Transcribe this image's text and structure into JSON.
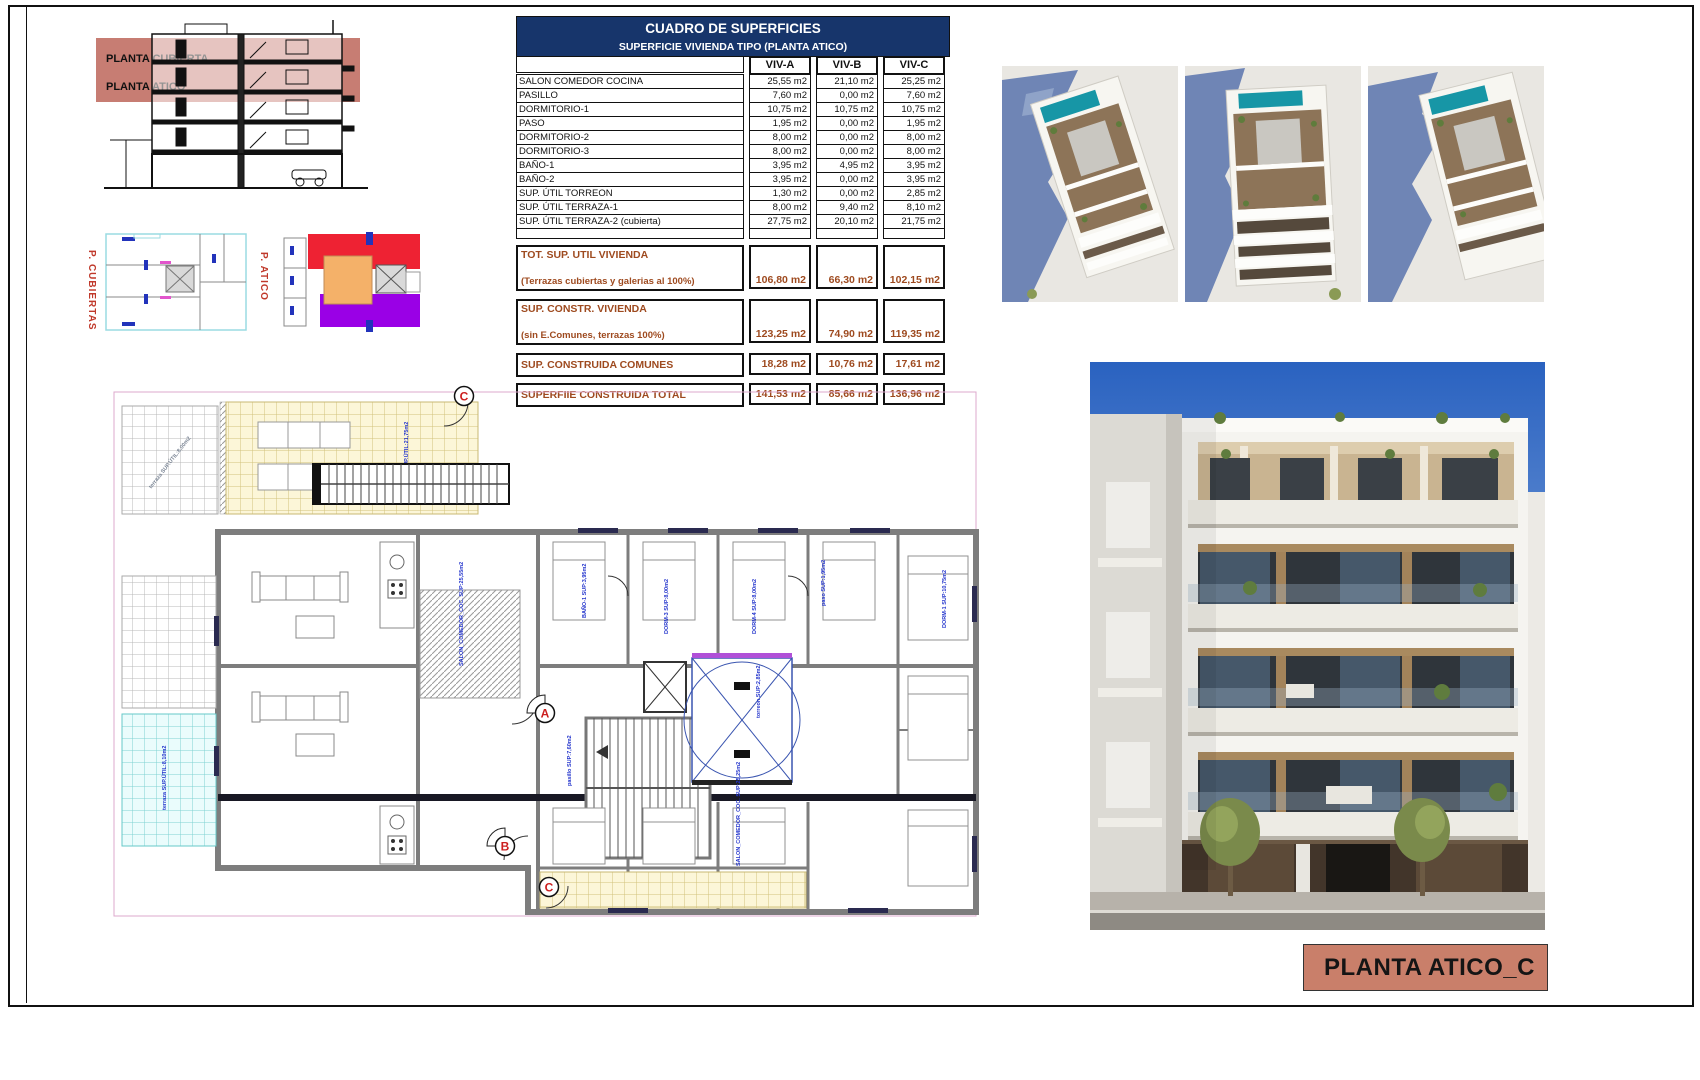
{
  "colors": {
    "table-header-bg": "#17356b",
    "summary-text": "#9e4a1f",
    "salmon": "#c97f6a",
    "section-band": "#c4766b",
    "plan-blue": "#2233cc",
    "marker-red": "#cc1f1f",
    "mini-red": "#ee2233",
    "mini-purple": "#9a00e6",
    "mini-orange": "#f4b169"
  },
  "section": {
    "band_labels": [
      "PLANTA CUBIERTA",
      "PLANTA ATICO"
    ]
  },
  "mini_plans": {
    "left_label": "P. CUBIERTAS",
    "right_label": "P. ATICO"
  },
  "table": {
    "title": "CUADRO DE SUPERFICIES",
    "subtitle": "SUPERFICIE VIVIENDA TIPO  (PLANTA ATICO)",
    "columns": [
      "VIV-A",
      "VIV-B",
      "VIV-C"
    ],
    "rows": [
      {
        "label": "SALON COMEDOR COCINA",
        "values": [
          "25,55 m2",
          "21,10 m2",
          "25,25 m2"
        ]
      },
      {
        "label": "PASILLO",
        "values": [
          "7,60 m2",
          "0,00 m2",
          "7,60 m2"
        ]
      },
      {
        "label": "DORMITORIO-1",
        "values": [
          "10,75 m2",
          "10,75 m2",
          "10,75 m2"
        ]
      },
      {
        "label": "PASO",
        "values": [
          "1,95 m2",
          "0,00 m2",
          "1,95 m2"
        ]
      },
      {
        "label": "DORMITORIO-2",
        "values": [
          "8,00 m2",
          "0,00 m2",
          "8,00 m2"
        ]
      },
      {
        "label": "DORMITORIO-3",
        "values": [
          "8,00 m2",
          "0,00 m2",
          "8,00 m2"
        ]
      },
      {
        "label": "BAÑO-1",
        "values": [
          "3,95 m2",
          "4,95 m2",
          "3,95 m2"
        ]
      },
      {
        "label": "BAÑO-2",
        "values": [
          "3,95 m2",
          "0,00 m2",
          "3,95 m2"
        ]
      },
      {
        "label": "SUP. ÚTIL TORREON",
        "values": [
          "1,30 m2",
          "0,00 m2",
          "2,85 m2"
        ]
      },
      {
        "label": "SUP. ÚTIL TERRAZA-1",
        "values": [
          "8,00 m2",
          "9,40 m2",
          "8,10 m2"
        ]
      },
      {
        "label": "SUP. ÚTIL TERRAZA-2 (cubierta)",
        "values": [
          "27,75 m2",
          "20,10 m2",
          "21,75 m2"
        ]
      }
    ],
    "summary": [
      {
        "label": "TOT. SUP. UTIL VIVIENDA",
        "sublabel": "(Terrazas cubiertas y galerias al 100%)",
        "values": [
          "106,80 m2",
          "66,30 m2",
          "102,15 m2"
        ]
      },
      {
        "label": "SUP. CONSTR. VIVIENDA",
        "sublabel": "(sin E.Comunes, terrazas 100%)",
        "values": [
          "123,25 m2",
          "74,90 m2",
          "119,35 m2"
        ]
      },
      {
        "label": "SUP. CONSTRUIDA COMUNES",
        "sublabel": "",
        "values": [
          "18,28 m2",
          "10,76 m2",
          "17,61 m2"
        ]
      },
      {
        "label": "SUPERFIIE CONSTRUIDA TOTAL",
        "sublabel": "",
        "values": [
          "141,53 m2",
          "85,66 m2",
          "136,96 m2"
        ]
      }
    ]
  },
  "plan": {
    "markers": {
      "a": "A",
      "b": "B",
      "c": "C",
      "c_top": "C"
    },
    "labels": {
      "terraza2": "terraza-2 SUP.ÚTIL:21,75m2",
      "terraza_gray": "terraza SUP.ÚTIL:8,00m2",
      "terraza_cyan": "terraza SUP.ÚTIL:8,10m2",
      "salon_a": "SALON_COMEDOR_COC. SUP:25,55m2",
      "salon_c": "SALON_COMEDOR_COC. SUP:25,25m2",
      "dorm1": "DORM-1 SUP:10,75m2",
      "dorm3": "DORM-3 SUP:8,00m2",
      "dorm4": "DORM-4 SUP:8,00m2",
      "bano1": "BAÑO-1 SUP:3,95m2",
      "paso": "paso SUP:1,95m2",
      "pasillo": "pasillo SUP:7,60m2",
      "torreon": "torreon SUP:2,85m2"
    }
  },
  "title_block": {
    "label": "PLANTA ATICO_C"
  }
}
